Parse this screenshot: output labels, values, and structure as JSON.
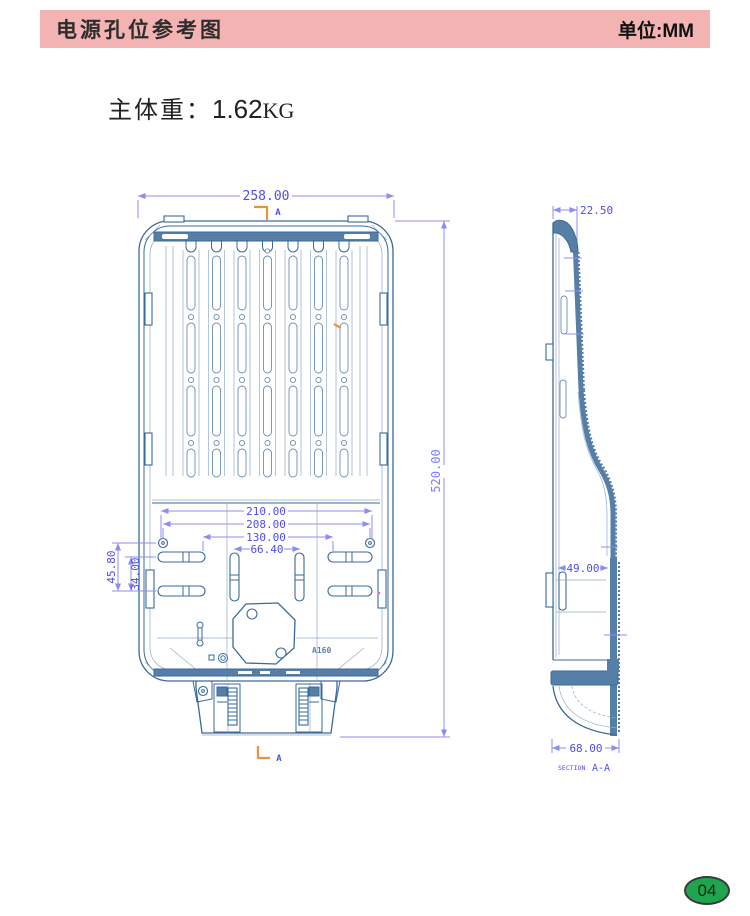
{
  "header": {
    "title": "电源孔位参考图",
    "unit": "单位:MM"
  },
  "weight": {
    "label": "主体重：",
    "value": "1.62",
    "unit": "KG"
  },
  "front_view": {
    "dim_width": "258.00",
    "dim_height": "520.00",
    "dim_210": "210.00",
    "dim_208": "208.00",
    "dim_130": "130.00",
    "dim_66": "66.40",
    "dim_45": "45.80",
    "dim_34": "34.00",
    "section_top": "A",
    "section_bottom": "A",
    "part_label": "A160"
  },
  "side_view": {
    "dim_top": "22.50",
    "dim_mid": "49.00",
    "dim_bottom": "68.00",
    "section_word": "SECTION",
    "section_name": "A-A"
  },
  "footer": {
    "page_number": "04"
  },
  "colors": {
    "header_bg": "#f3b3b3",
    "drawing_line": "#3a6a9c",
    "dimension": "#4d4df0",
    "section_accent": "#e2953f",
    "badge_green": "#1ea54e"
  }
}
